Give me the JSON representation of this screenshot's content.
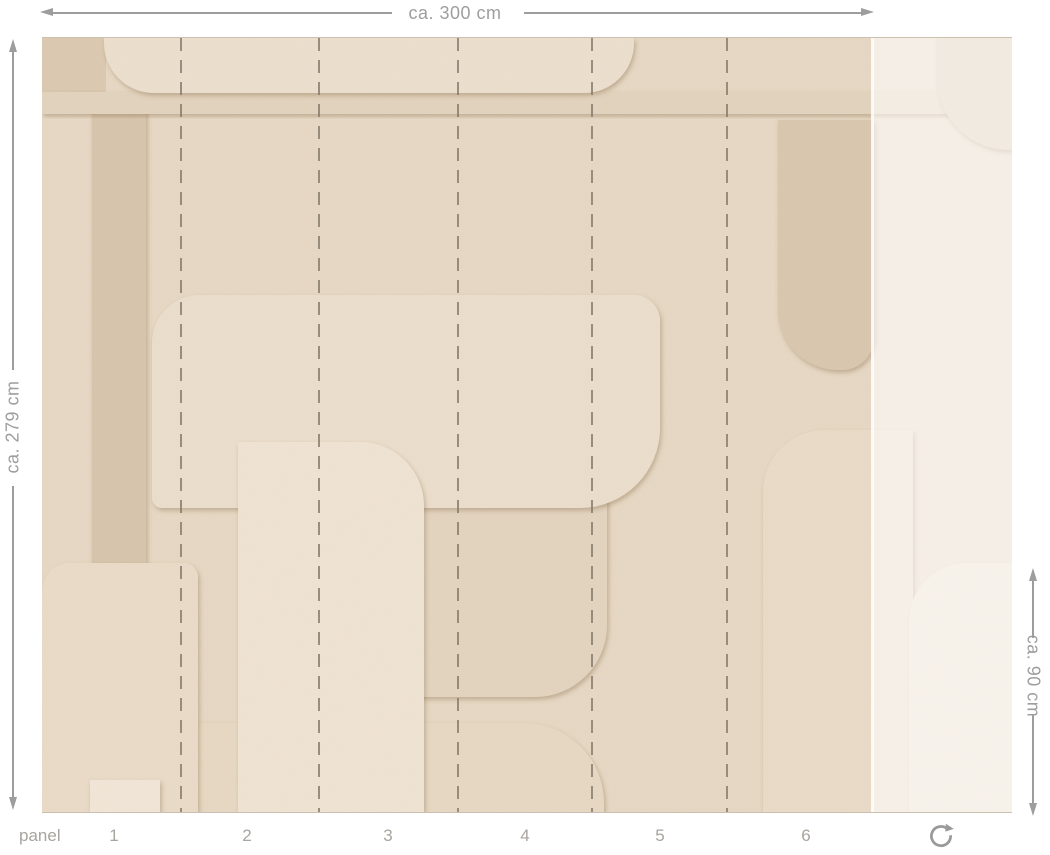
{
  "diagram": {
    "width_label": "ca. 300 cm",
    "height_label": "ca. 279 cm",
    "partial_height_label": "ca. 90 cm",
    "panel_label": "panel",
    "panel_numbers": [
      "1",
      "2",
      "3",
      "4",
      "5",
      "6"
    ]
  },
  "icons": {
    "rotate_icon": "rotate-clockwise"
  },
  "colors": {
    "page_background": "#ffffff",
    "dimension_line": "#9d9d9d",
    "dimension_text": "#9e9e9e",
    "panel_text": "#a8a49e",
    "dashed_cut_line": "#84796a",
    "wallpaper_base": "#e6d8c4",
    "wallpaper_light": "#ecdfce",
    "wallpaper_lighter": "#efe3d3",
    "wallpaper_medium": "#e2d3be",
    "wallpaper_dark": "#d9c7af",
    "wallpaper_darker": "#d8c5ad",
    "unused_panel_overlay": "rgba(255,255,255,0.58)"
  }
}
